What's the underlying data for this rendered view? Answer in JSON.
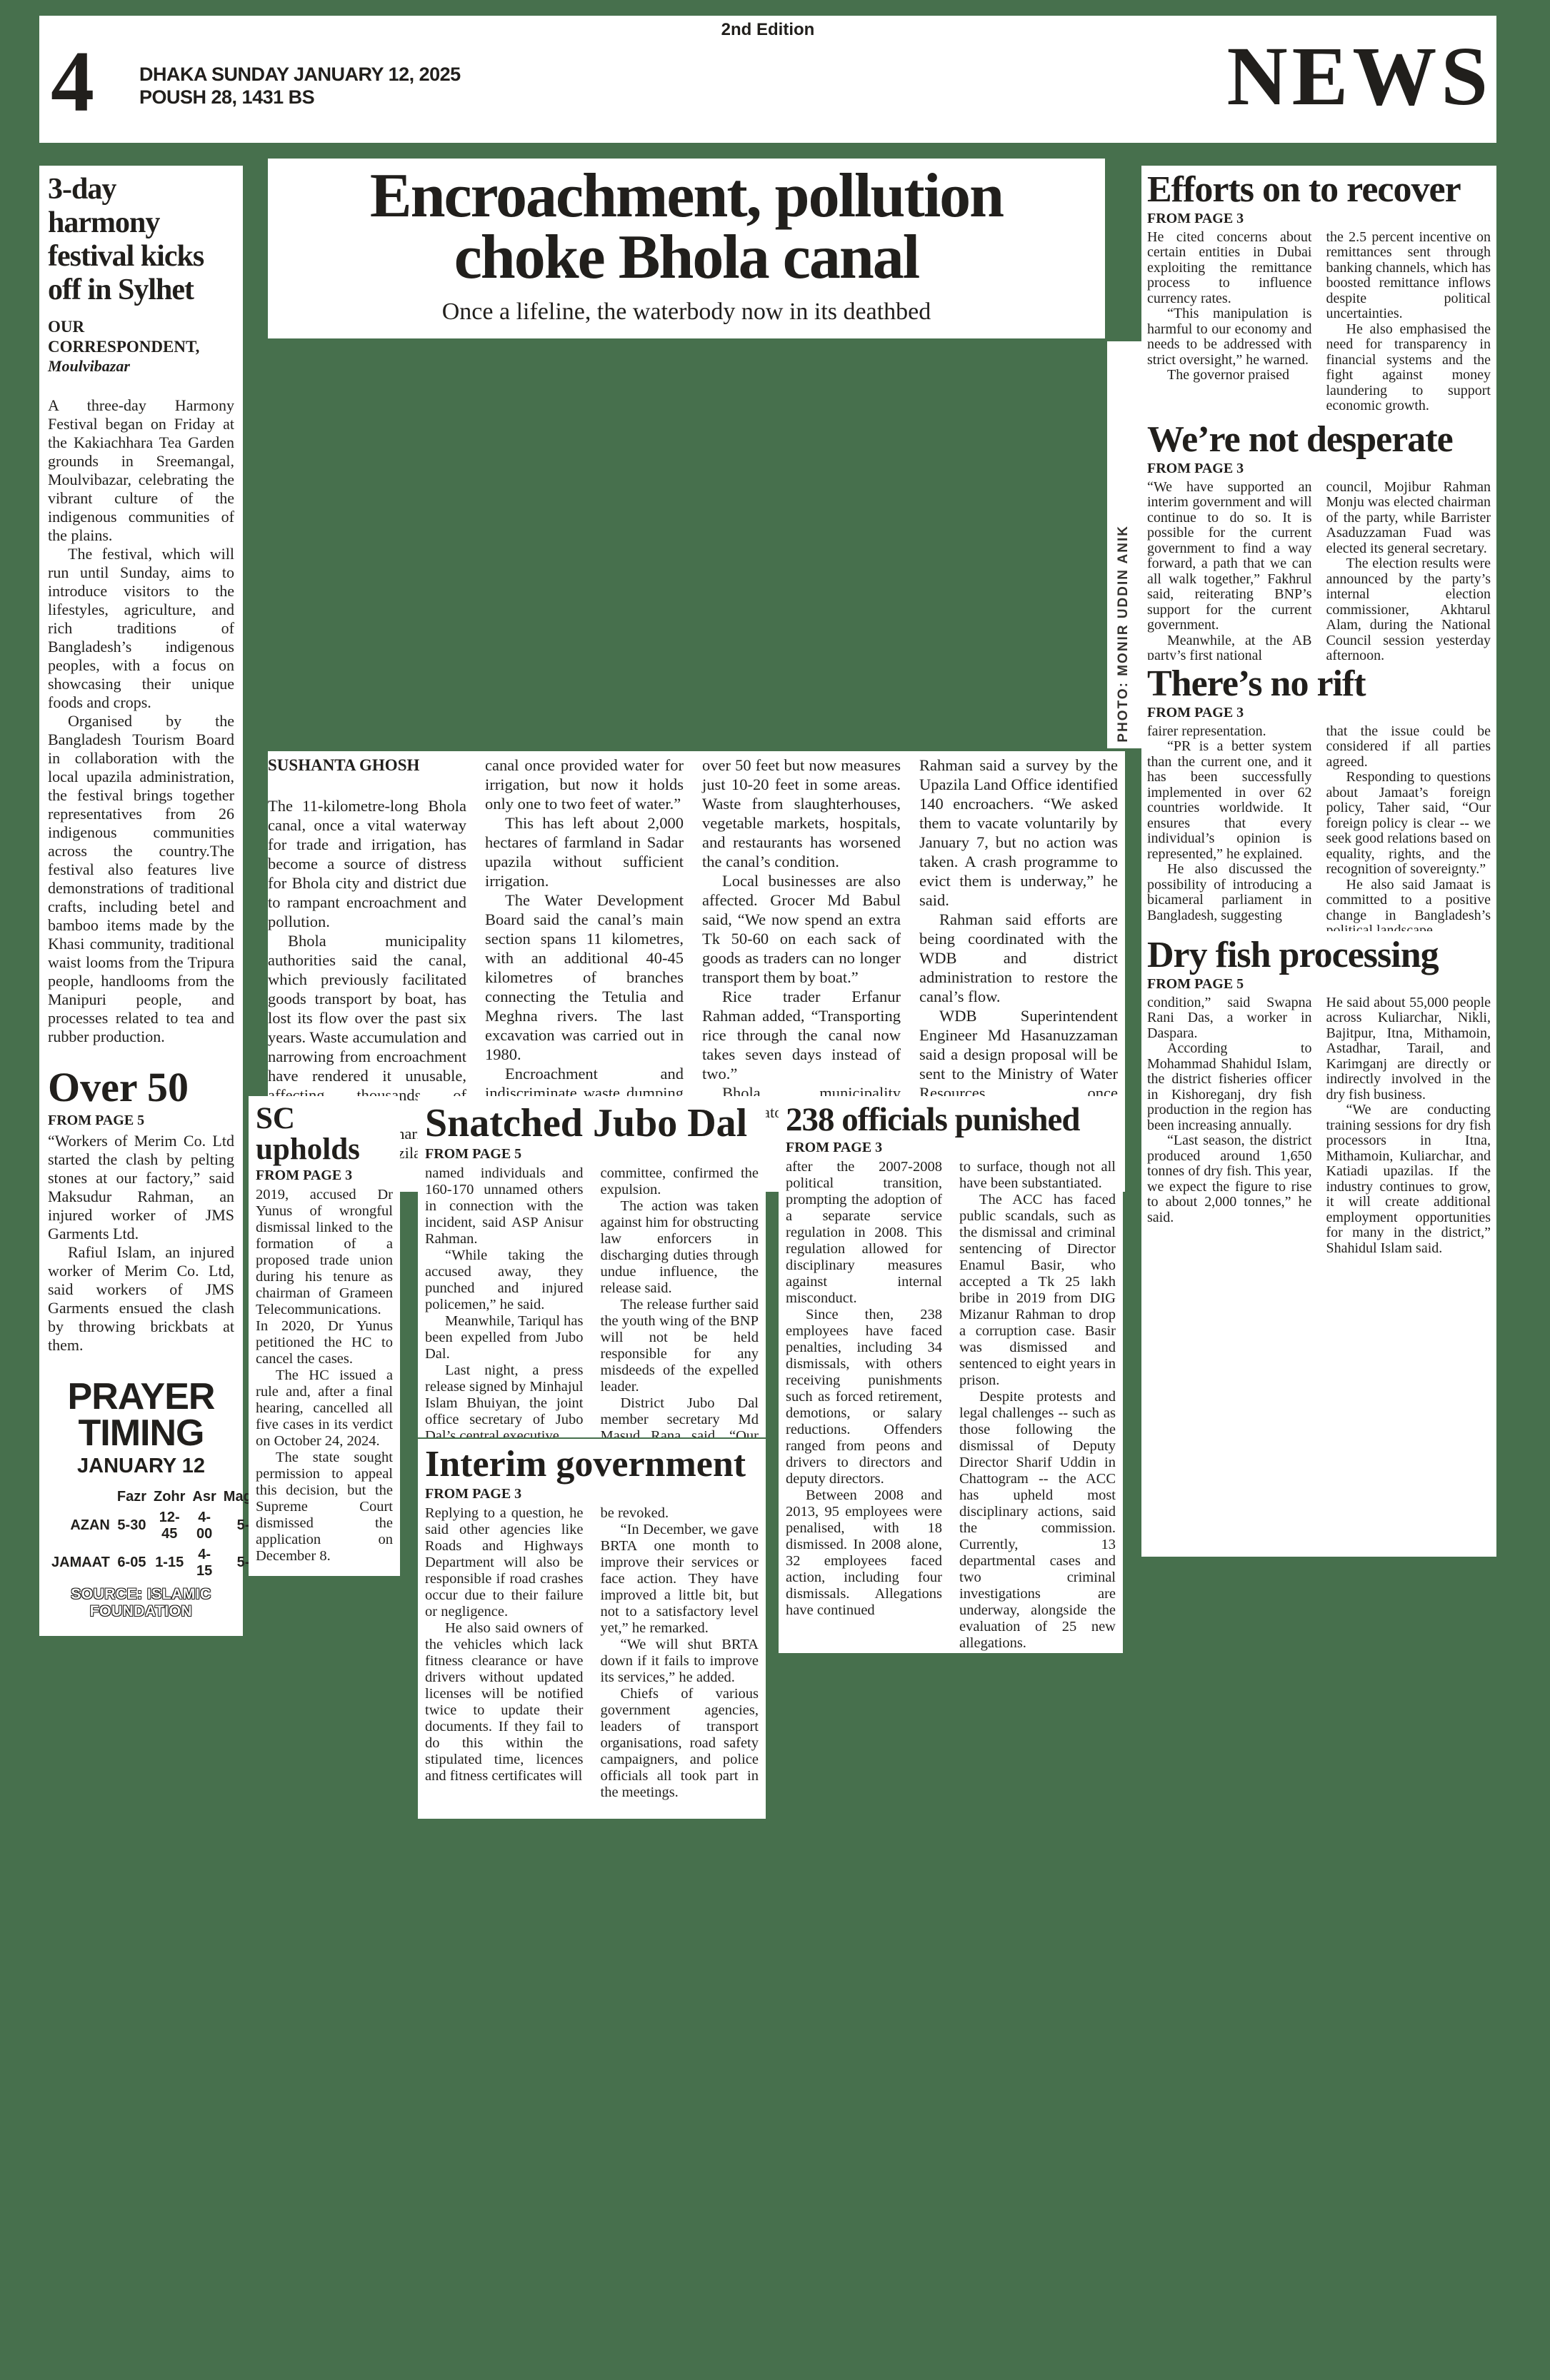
{
  "page": {
    "edition": "2nd Edition",
    "page_number": "4",
    "date_line1": "DHAKA SUNDAY JANUARY 12, 2025",
    "date_line2": "POUSH 28, 1431 BS",
    "masthead": "NEWS",
    "colors": {
      "canvas_green": "#47704d",
      "paper": "#ffffff",
      "ink": "#211f1c"
    }
  },
  "lead": {
    "title_line1": "Encroachment, pollution",
    "title_line2": "choke Bhola canal",
    "subtitle": "Once a lifeline, the waterbody now in its deathbed",
    "byline": "SUSHANTA GHOSH",
    "photo_credit": "PHOTO: MONIR UDDIN ANIK",
    "columns": [
      [
        "The 11-kilometre-long Bhola canal, once a vital waterway for trade and irrigation, has become a source of distress for Bhola city and district due to rampant encroachment and pollution.",
        "Bhola municipality authorities said the canal, which previously facilitated goods transport by boat, has lost its flow over the past six years. Waste accumulation and narrowing from encroachment have rendered it unusable, affecting thousands of residents.",
        "Farmer Hanif Sharif from Bhola Sadar upazila said, “The"
      ],
      [
        "canal once provided water for irrigation, but now it holds only one to two feet of water.”",
        "This has left about 2,000 hectares of farmland in Sadar upazila without sufficient irrigation.",
        "The Water Development Board said the canal’s main section spans 11 kilometres, with an additional 40-45 kilometres of branches connecting the Tetulia and Meghna rivers. The last excavation was carried out in 1980.",
        "Encroachment and indiscriminate waste dumping have drastically reduced the canal’s width, which was once"
      ],
      [
        "over 50 feet but now measures just 10-20 feet in some areas. Waste from slaughterhouses, vegetable markets, hospitals, and restaurants has worsened the canal’s condition.",
        "Local businesses are also affected. Grocer Md Babul said, “We now spend an extra Tk 50-60 on each sack of goods as traders can no longer transport them by boat.”",
        "Rice trader Erfanur Rahman added, “Transporting rice through the canal now takes seven days instead of two.”",
        "Bhola municipality administrator Md Mizanur"
      ],
      [
        "Rahman said a survey by the Upazila Land Office identified 140 encroachers. “We asked them to vacate voluntarily by January 7, but no action was taken. A crash programme to evict them is underway,” he said.",
        "Rahman said efforts are being coordinated with the WDB and district administration to restore the canal’s flow.",
        "WDB Superintendent Engineer Md Hasanuzzaman said a design proposal will be sent to the Ministry of Water Resources once encroachments are cleared.",
        "Excavation work will begin after approval, he added."
      ]
    ]
  },
  "articles": {
    "harmony": {
      "title": "3-day harmony festival kicks off in Sylhet",
      "byline": "OUR CORRESPONDENT,",
      "byline_place": "Moulvibazar",
      "paras": [
        "A three-day Harmony Festival began on Friday at the Kakiachhara Tea Garden grounds in Sreemangal, Moulvibazar, celebrating the vibrant culture of the indigenous communities of the plains.",
        "The festival, which will run until Sunday, aims to introduce visitors to the lifestyles, agriculture, and rich traditions of Bangladesh’s indigenous peoples, with a focus on showcasing their unique foods and crops.",
        "Organised by the Bangladesh Tourism Board in collaboration with the local upazila administration, the festival brings together representatives from 26 indigenous communities across the country.The festival also features live demonstrations of traditional crafts, including betel and bamboo items made by the Khasi community, traditional waist looms from the Tripura people, handlooms from the Manipuri people, and processes related to tea and rubber production."
      ]
    },
    "over50": {
      "title": "Over 50",
      "tag": "FROM PAGE 5",
      "paras": [
        "“Workers of Merim Co. Ltd started the clash by pelting stones at our factory,” said Maksudur Rahman, an injured worker of JMS Garments Ltd.",
        "Rafiul Islam, an injured worker of Merim Co. Ltd, said workers of JMS Garments ensued the clash by throwing brickbats at them."
      ]
    },
    "sc": {
      "title": "SC upholds",
      "tag": "FROM PAGE 3",
      "paras": [
        "2019, accused Dr Yunus of wrongful dismissal linked to the formation of a proposed trade union during his tenure as chairman of Grameen Telecommunications. In 2020, Dr Yunus petitioned the HC to cancel the cases.",
        "The HC issued a rule and, after a final hearing, cancelled all five cases in its verdict on October 24, 2024.",
        "The state sought permission to appeal this decision, but the Supreme Court dismissed the application on December 8."
      ]
    },
    "snatched": {
      "title": "Snatched Jubo Dal",
      "tag": "FROM PAGE 5",
      "col1": [
        "named individuals and 160-170 unnamed others in connection with the incident, said ASP Anisur Rahman.",
        "“While taking the accused away, they punched and injured policemen,” he said.",
        "Meanwhile, Tariqul has been expelled from Jubo Dal.",
        "Last night, a press release signed by Minhajul Islam Bhuiyan, the joint office secretary of Jubo Dal’s central executive"
      ],
      "col2": [
        "committee, confirmed the expulsion.",
        "The action was taken against him for obstructing law enforcers in discharging duties through undue influence, the release said.",
        "The release further said the youth wing of the BNP will not be held responsible for any misdeeds of the expelled leader.",
        "District Jubo Dal member secretary Md Masud Rana said, “Our party won’t tolerate any injustice.”"
      ]
    },
    "interim": {
      "title": "Interim government",
      "tag": "FROM PAGE 3",
      "col1": [
        "Replying to a question, he said other agencies like Roads and Highways Department will also be responsible if road crashes occur due to their failure or negligence.",
        "He also said owners of the vehicles which lack fitness clearance or have drivers without updated licenses will be notified twice to update their documents. If they fail to do this within the stipulated time, licences and fitness certificates will"
      ],
      "col2": [
        "be revoked.",
        "“In December, we gave BRTA one month to improve their services or face action. They have improved a little bit, but not to a satisfactory level yet,” he remarked.",
        "“We will shut BRTA down if it fails to improve its services,” he added.",
        "Chiefs of various government agencies, leaders of transport organisations, road safety campaigners, and police officials all took part in the meetings."
      ]
    },
    "officials": {
      "title": "238 officials punished",
      "tag": "FROM PAGE 3",
      "col1": [
        "after the 2007-2008 political transition, prompting the adoption of a separate service regulation in 2008. This regulation allowed for disciplinary measures against internal misconduct.",
        "Since then, 238 employees have faced penalties, including 34 dismissals, with others receiving punishments such as forced retirement, demotions, or salary reductions. Offenders ranged from peons and drivers to directors and deputy directors.",
        "Between 2008 and 2013, 95 employees were penalised, with 18 dismissed. In 2008 alone, 32 employees faced action, including four dismissals. Allegations have continued"
      ],
      "col2": [
        "to surface, though not all have been substantiated.",
        "The ACC has faced public scandals, such as the dismissal and criminal sentencing of Director Enamul Basir, who accepted a Tk 25 lakh bribe in 2019 from DIG Mizanur Rahman to drop a corruption case. Basir was dismissed and sentenced to eight years in prison.",
        "Despite protests and legal challenges -- such as those following the dismissal of Deputy Director Sharif Uddin in Chattogram -- the ACC has upheld most disciplinary actions, said the commission. Currently, 13 departmental cases and two criminal investigations are underway, alongside the evaluation of 25 new allegations."
      ]
    },
    "efforts": {
      "title": "Efforts on to recover",
      "tag": "FROM PAGE 3",
      "col1": [
        "He cited concerns about certain entities in Dubai exploiting the remittance process to influence currency rates.",
        "“This manipulation is harmful to our economy and needs to be addressed with strict oversight,” he warned.",
        "The governor praised"
      ],
      "col2": [
        "the 2.5 percent incentive on remittances sent through banking channels, which has boosted remittance inflows despite political uncertainties.",
        "He also emphasised the need for transparency in financial systems and the fight against money laundering to support economic growth."
      ]
    },
    "desperate": {
      "title": "We’re not desperate",
      "tag": "FROM PAGE 3",
      "col1": [
        "“We have supported an interim government and will continue to do so. It is possible for the current government to find a way forward, a path that we can all walk together,” Fakhrul said, reiterating BNP’s support for the current government.",
        "Meanwhile, at the AB party’s first national"
      ],
      "col2": [
        "council, Mojibur Rahman Monju was elected chairman of the party, while Barrister Asaduzzaman Fuad was elected its general secretary.",
        "The election results were announced by the party’s internal election commissioner, Akhtarul Alam, during the National Council session yesterday afternoon."
      ]
    },
    "rift": {
      "title": "There’s no rift",
      "tag": "FROM PAGE 3",
      "col1": [
        "fairer representation.",
        "“PR is a better system than the current one, and it has been successfully implemented in over 62 countries worldwide. It ensures that every individual’s opinion is represented,” he explained.",
        "He also discussed the possibility of introducing a bicameral parliament in Bangladesh, suggesting"
      ],
      "col2": [
        "that the issue could be considered if all parties agreed.",
        "Responding to questions about Jamaat’s foreign policy, Taher said, “Our foreign policy is clear -- we seek good relations based on equality, rights, and the recognition of sovereignty.”",
        "He also said Jamaat is committed to a positive change in Bangladesh’s political landscape."
      ]
    },
    "dryfish": {
      "title": "Dry fish processing",
      "tag": "FROM PAGE 5",
      "col1": [
        "condition,” said Swapna Rani Das, a worker in Daspara.",
        "According to Mohammad Shahidul Islam, the district fisheries officer in Kishoreganj, dry fish production in the region has been increasing annually.",
        "“Last season, the district produced around 1,650 tonnes of dry fish. This year, we expect the figure to rise to about 2,000 tonnes,” he said."
      ],
      "col2": [
        "He said about 55,000 people across Kuliarchar, Nikli, Bajitpur, Itna, Mithamoin, Astadhar, Tarail, and Karimganj are directly or indirectly involved in the dry fish business.",
        "“We are conducting training sessions for dry fish processors in Itna, Mithamoin, Kuliarchar, and Katiadi upazilas. If the industry continues to grow, it will create additional employment opportunities for many in the district,” Shahidul Islam said."
      ]
    }
  },
  "prayer": {
    "title_line1": "PRAYER",
    "title_line2": "TIMING",
    "date": "JANUARY 12",
    "columns": [
      "Fazr",
      "Zohr",
      "Asr",
      "Maghrib",
      "Esha"
    ],
    "rows": [
      {
        "label": "AZAN",
        "times": [
          "5-30",
          "12-45",
          "4-00",
          "5-36",
          "7-00"
        ]
      },
      {
        "label": "JAMAAT",
        "times": [
          "6-05",
          "1-15",
          "4-15",
          "5-40",
          "7-30"
        ]
      }
    ],
    "source": "SOURCE: ISLAMIC FOUNDATION"
  }
}
